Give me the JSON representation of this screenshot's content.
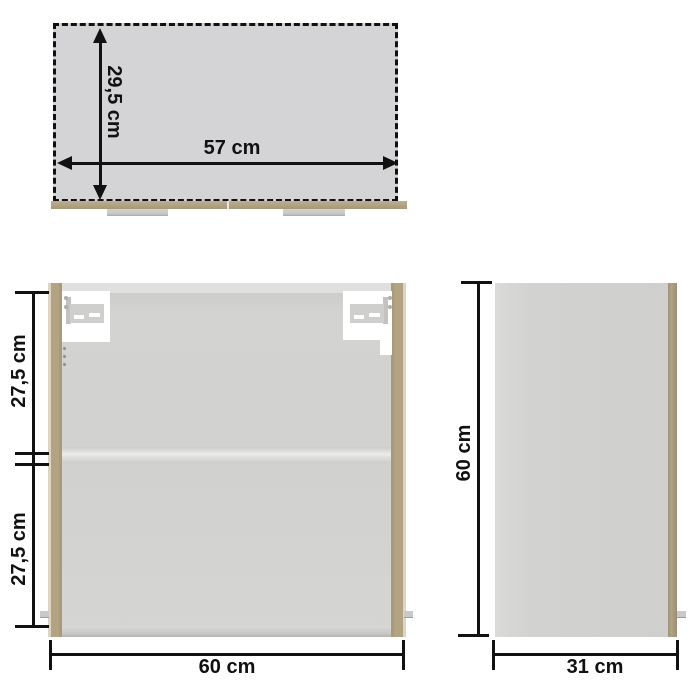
{
  "diagram": {
    "description": "cabinet-dimension-drawing",
    "views": [
      "top-view",
      "front-view",
      "side-view"
    ]
  },
  "views": {
    "top": {
      "depth_label": "29,5 cm",
      "width_label": "57 cm"
    },
    "front": {
      "upper_section_label": "27,5 cm",
      "lower_section_label": "27,5 cm",
      "width_label": "60 cm"
    },
    "side": {
      "height_label": "60 cm",
      "depth_label": "31 cm"
    }
  },
  "colors": {
    "background": "#ffffff",
    "panel_gray": "#d3d3d5",
    "wood": "#b0a283",
    "dimension_line": "#111111",
    "rail_gray": "#c9c9c9",
    "hinge_cutout": "#ffffff"
  }
}
